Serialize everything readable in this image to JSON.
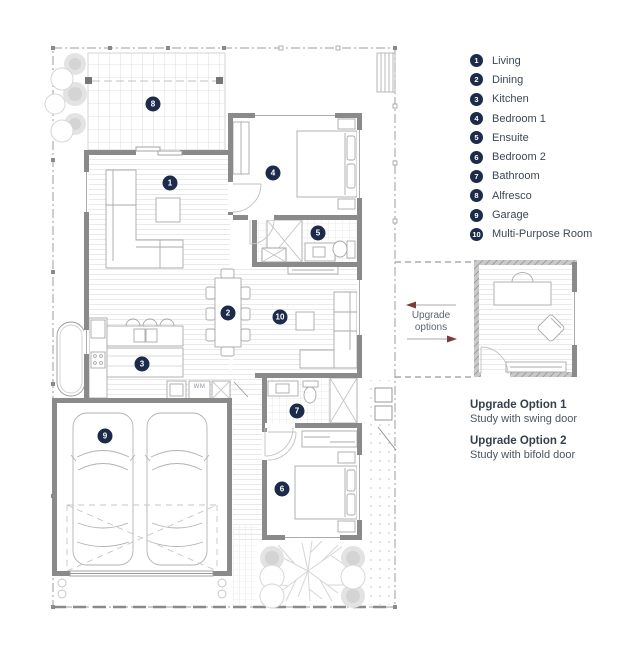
{
  "colors": {
    "navy": "#1c2b4a",
    "arrow_red": "#7d3c3c"
  },
  "legend": {
    "items": [
      {
        "num": "1",
        "room": "living",
        "label": "Living"
      },
      {
        "num": "2",
        "room": "dining",
        "label": "Dining"
      },
      {
        "num": "3",
        "room": "kitchen",
        "label": "Kitchen"
      },
      {
        "num": "4",
        "room": "bedroom-1",
        "label": "Bedroom 1"
      },
      {
        "num": "5",
        "room": "ensuite",
        "label": "Ensuite"
      },
      {
        "num": "6",
        "room": "bedroom-2",
        "label": "Bedroom 2"
      },
      {
        "num": "7",
        "room": "bathroom",
        "label": "Bathroom"
      },
      {
        "num": "8",
        "room": "alfresco",
        "label": "Alfresco"
      },
      {
        "num": "9",
        "room": "garage",
        "label": "Garage"
      },
      {
        "num": "10",
        "room": "multi-purpose-room",
        "label": "Multi-Purpose Room"
      }
    ]
  },
  "plan": {
    "wm_label": "WM",
    "room_markers": [
      {
        "num": "1",
        "room": "living",
        "x": 170,
        "y": 183
      },
      {
        "num": "2",
        "room": "dining",
        "x": 228,
        "y": 313
      },
      {
        "num": "3",
        "room": "kitchen",
        "x": 142,
        "y": 364
      },
      {
        "num": "4",
        "room": "bedroom-1",
        "x": 273,
        "y": 173
      },
      {
        "num": "5",
        "room": "ensuite",
        "x": 318,
        "y": 233
      },
      {
        "num": "6",
        "room": "bedroom-2",
        "x": 282,
        "y": 489
      },
      {
        "num": "7",
        "room": "bathroom",
        "x": 297,
        "y": 411
      },
      {
        "num": "8",
        "room": "alfresco",
        "x": 153,
        "y": 104
      },
      {
        "num": "9",
        "room": "garage",
        "x": 105,
        "y": 436
      },
      {
        "num": "10",
        "room": "multi-purpose-room",
        "x": 280,
        "y": 317
      }
    ]
  },
  "upgrade": {
    "connector_label_line1": "Upgrade",
    "connector_label_line2": "options",
    "options": [
      {
        "title": "Upgrade Option 1",
        "desc": "Study with swing door"
      },
      {
        "title": "Upgrade Option 2",
        "desc": "Study with bifold door"
      }
    ]
  }
}
